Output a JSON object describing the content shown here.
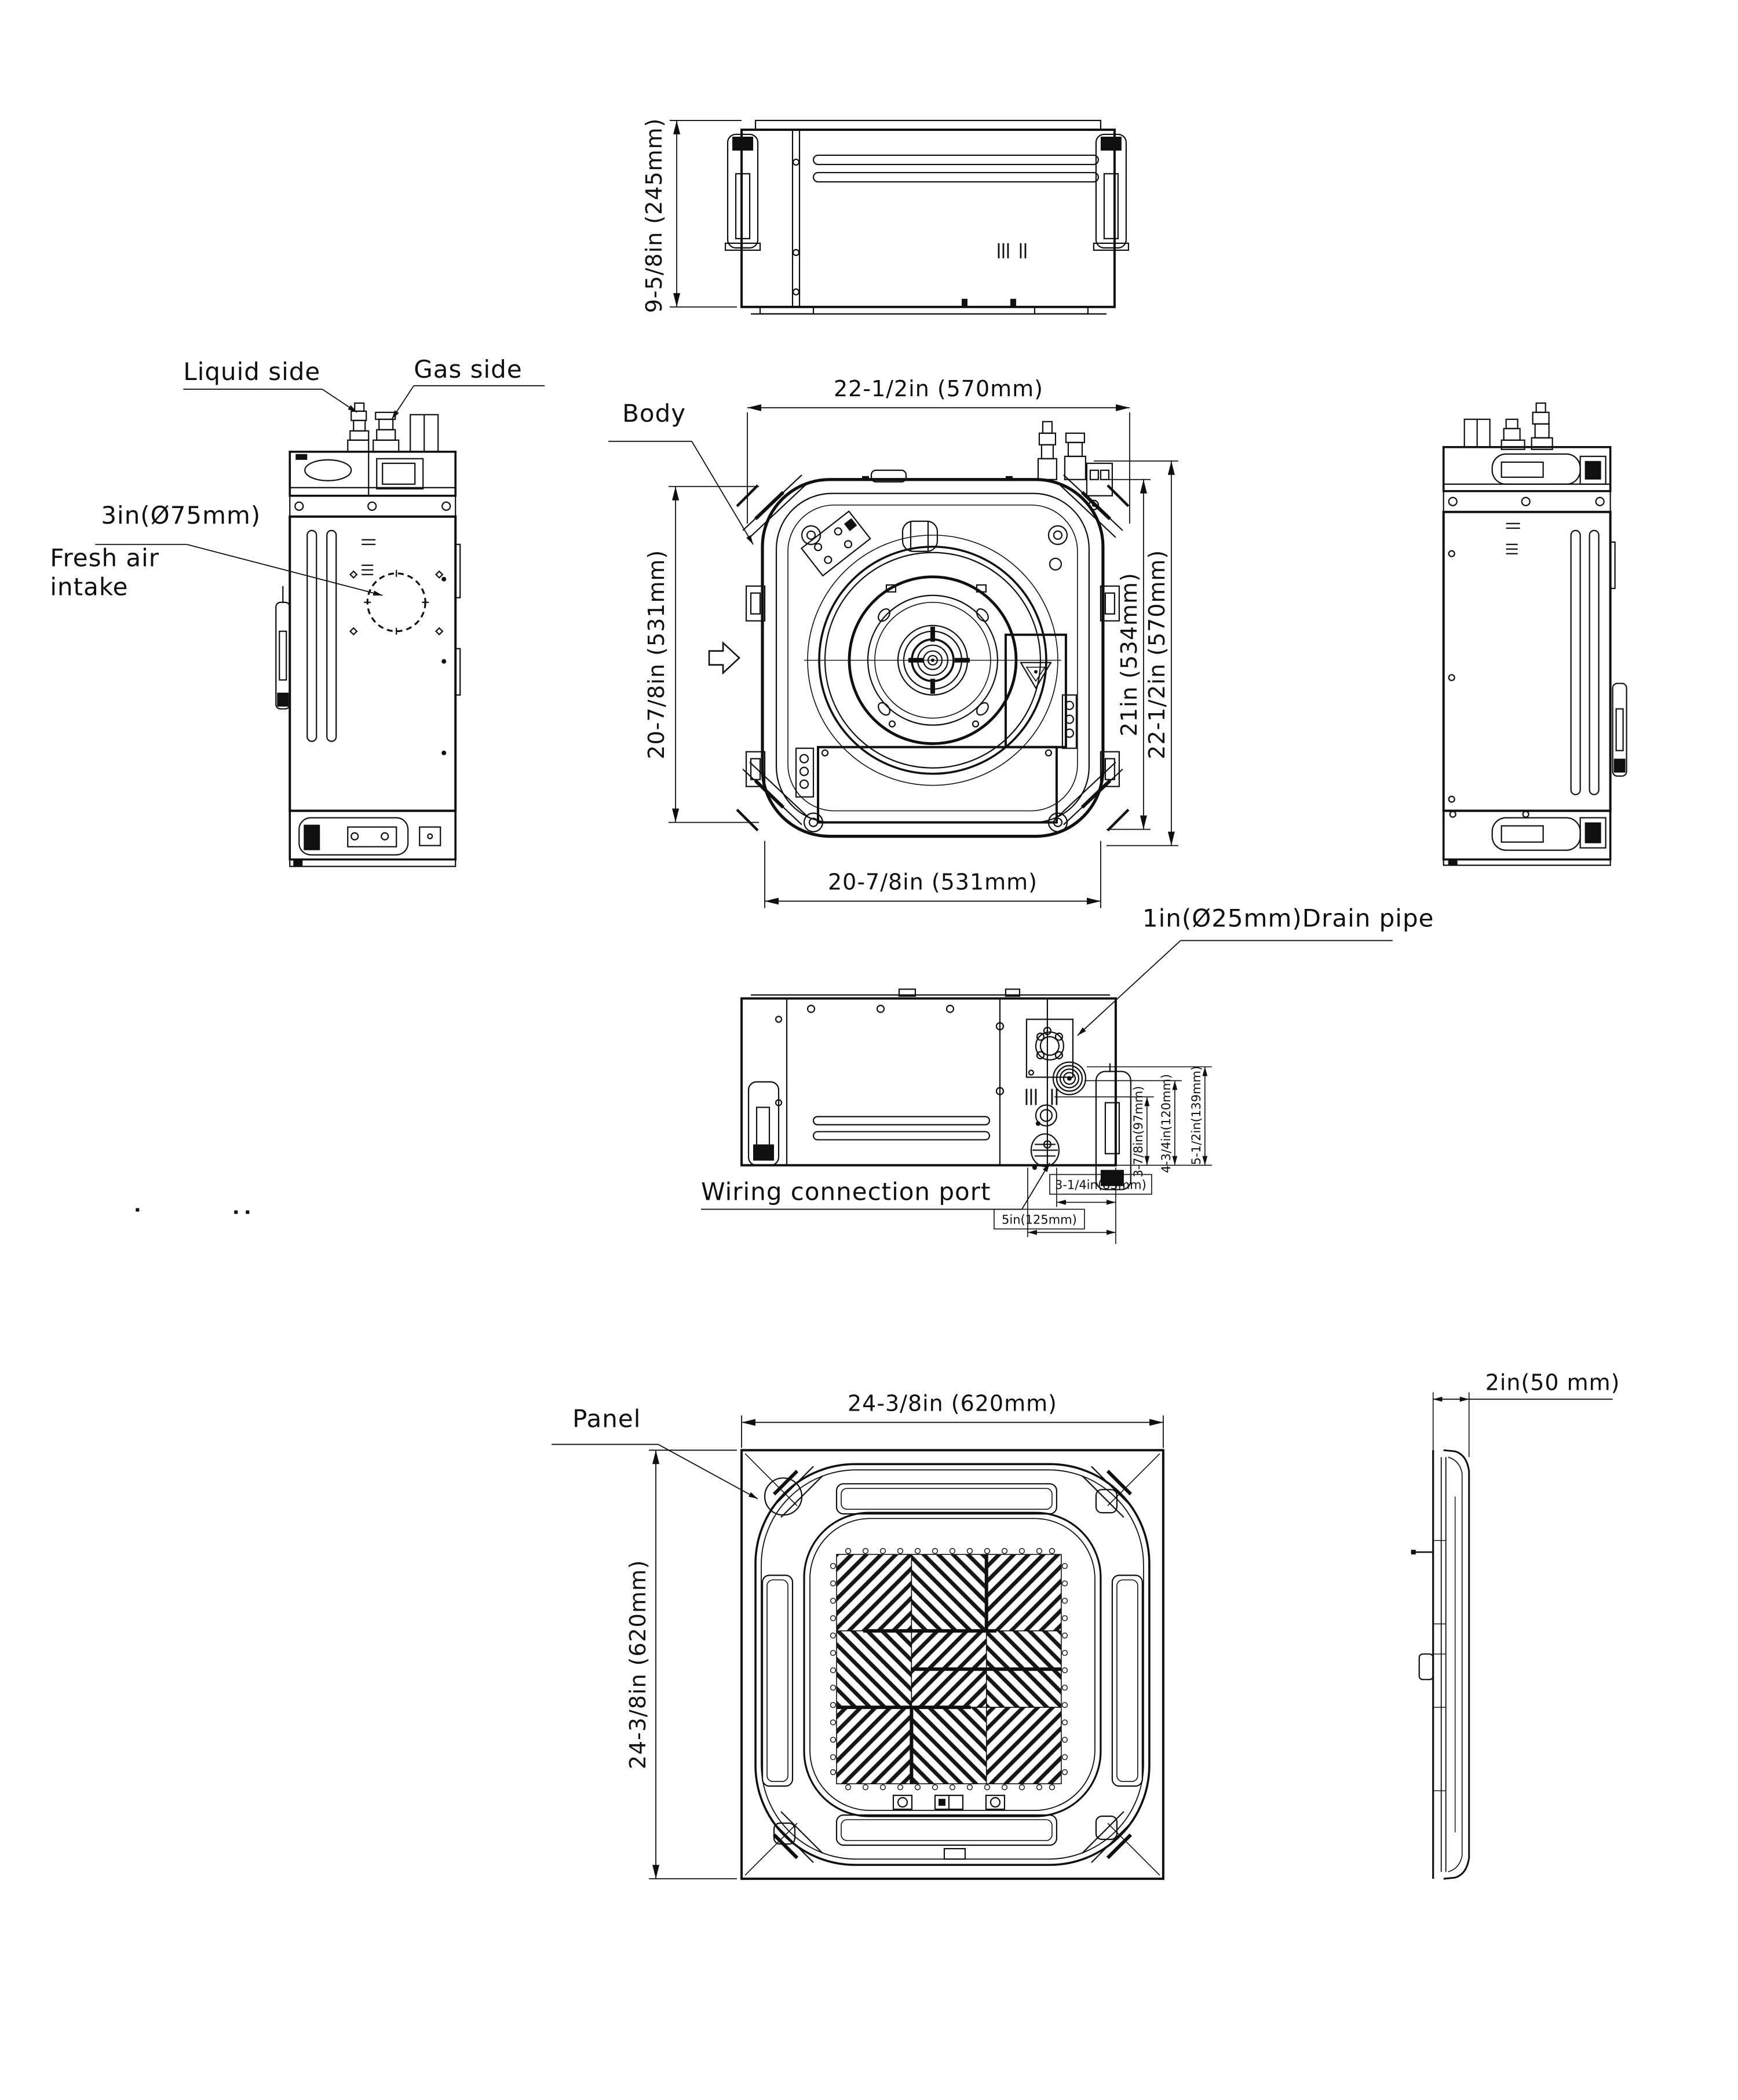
{
  "drawing": {
    "colors": {
      "line": "#0f0f0f",
      "background": "#ffffff"
    },
    "views": {
      "top_elevation": {
        "height_dim": "9-5/8in (245mm)"
      },
      "left_side": {
        "liquid_label": "Liquid side",
        "gas_label": "Gas side",
        "intake_dia_label": "3in(Ø75mm)",
        "intake_label_line1": "Fresh air",
        "intake_label_line2": "intake"
      },
      "body_plan": {
        "body_label": "Body",
        "dim_width_top": "22-1/2in (570mm)",
        "dim_left": "20-7/8in (531mm)",
        "dim_right_inner": "21in (534mm)",
        "dim_right_outer": "22-1/2in (570mm)",
        "dim_bottom": "20-7/8in (531mm)"
      },
      "bottom_elevation": {
        "drain_label": "1in(Ø25mm)Drain pipe",
        "wiring_label": "Wiring connection port",
        "dim_v_inner": "3-7/8in(97mm)",
        "dim_v_mid": "4-3/4in(120mm)",
        "dim_v_outer": "5-1/2in(139mm)",
        "dim_h_inner": "3-1/4in(83mm)",
        "dim_h_outer": "5in(125mm)"
      },
      "panel_plan": {
        "panel_label": "Panel",
        "dim_width_top": "24-3/8in (620mm)",
        "dim_height_left": "24-3/8in (620mm)"
      },
      "panel_side": {
        "thickness_dim": "2in(50 mm)"
      }
    }
  }
}
